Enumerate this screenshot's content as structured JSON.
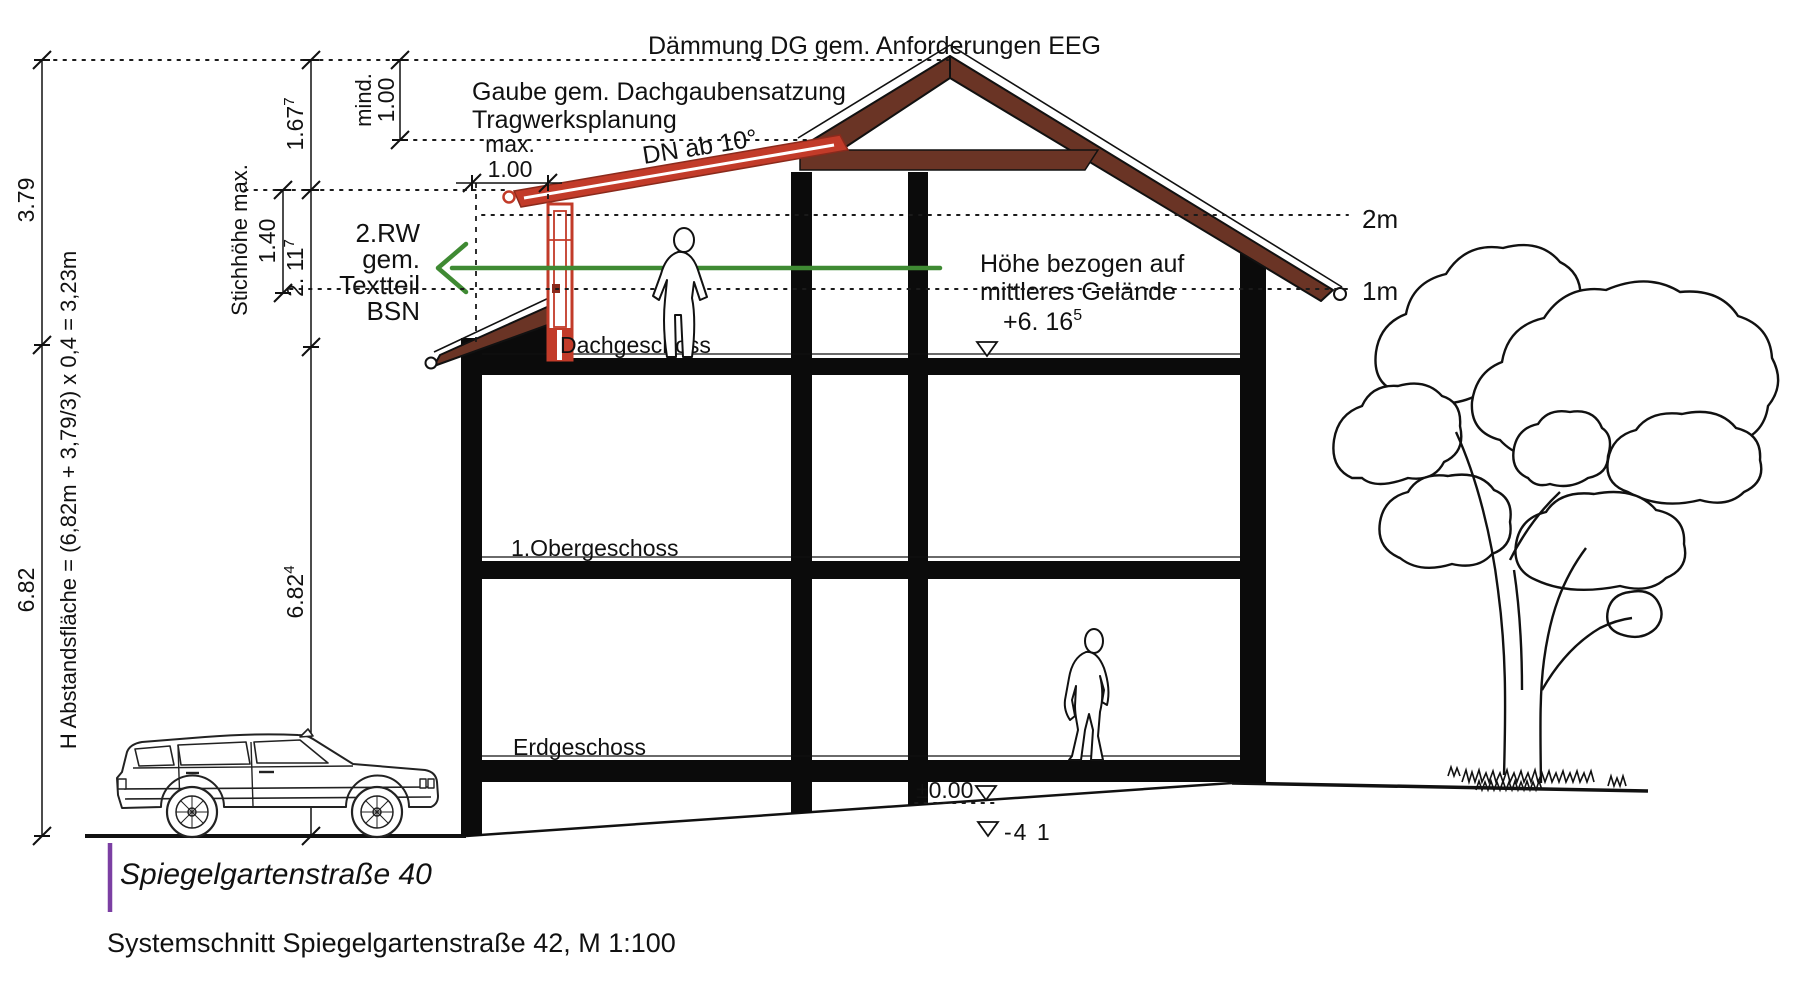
{
  "drawing": {
    "street_label": "Spiegelgartenstraße 40",
    "caption": "Systemschnitt Spiegelgartenstraße 42, M 1:100"
  },
  "floors": {
    "attic": "Dachgeschoss",
    "upper": "1.Obergeschoss",
    "ground": "Erdgeschoss"
  },
  "annotations": {
    "insulation_note": "Dämmung DG gem. Anforderungen EEG",
    "dormer_note_line1": "Gaube gem. Dachgaubensatzung",
    "dormer_note_line2": "Tragwerksplanung",
    "dormer_max_label": "max.",
    "dormer_max_value": "1.00",
    "roof_pitch_note": "DN ab 10°",
    "escape_route_line1": "2.RW",
    "escape_route_line2": "gem.",
    "escape_route_line3": "Textteil",
    "escape_route_line4": "BSN",
    "height_ref_line1": "Höhe bezogen auf",
    "height_ref_line2": "mittleres Gelände",
    "height_ref_value": "+6. 16",
    "height_ref_sup": "5",
    "marker_2m": "2m",
    "marker_1m": "1m",
    "level_zero": "±0.00",
    "level_minus": "-4 1"
  },
  "dimensions": {
    "roof_height": "3.79",
    "eaves_height": "6.82",
    "setback_formula": "H Abstandsfläche = (6,82m + 3,79/3) x 0,4 = 3,23m",
    "total_height_value": "6.82",
    "total_height_sup": "4",
    "ridge_clearance_value": "1.67",
    "ridge_clearance_sup": "7",
    "dormer_height_value": "2. 11",
    "dormer_height_sup": "7",
    "dormer_window_label": "Stichhöhe max.",
    "dormer_window_height": "1.40",
    "min_label": "mind.",
    "min_value": "1.00"
  },
  "colors": {
    "roof_brown": "#6a3425",
    "dormer_red": "#c23b29",
    "dormer_red_dark": "#8a2a1c",
    "arrow_green": "#3f8a33",
    "street_marker_purple": "#7b3fa3",
    "line_black": "#111111"
  }
}
